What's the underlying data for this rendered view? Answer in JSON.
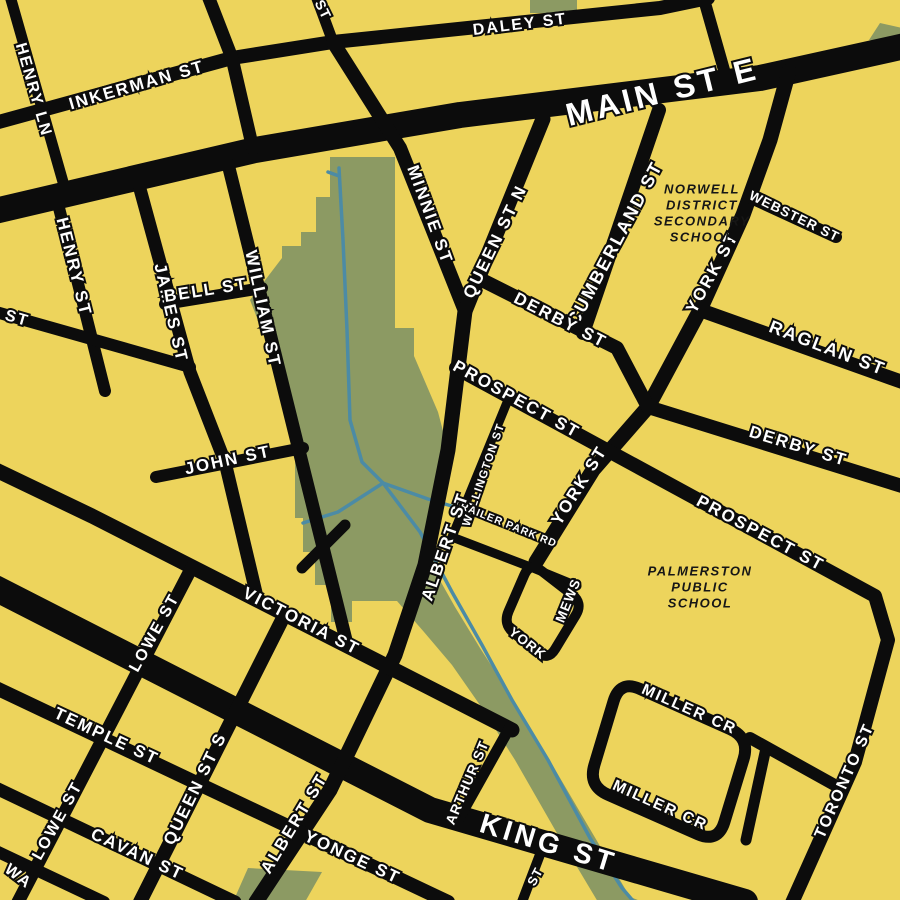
{
  "map": {
    "title_visible": false,
    "place_names_visible": [
      "Palmerston street map"
    ],
    "colors": {
      "background": "#EDD45C",
      "road": "#0C0C0C",
      "park": "#8C9A63",
      "creek": "#4C8BA5",
      "street_label_text": "#FFFFFF",
      "poi_label_text": "#161616"
    },
    "canvas": {
      "width": 900,
      "height": 900
    }
  },
  "street_labels": [
    {
      "id": "inkerman-st",
      "text": "INKERMAN ST",
      "x": 137,
      "y": 86,
      "rot": -16,
      "size": 17
    },
    {
      "id": "daley-st",
      "text": "DALEY ST",
      "x": 520,
      "y": 25,
      "rot": -7,
      "size": 16
    },
    {
      "id": "main-st-e",
      "text": "MAIN ST E",
      "x": 663,
      "y": 94,
      "rot": -14,
      "size": 32
    },
    {
      "id": "henry-ln",
      "text": "HENRY LN",
      "x": 33,
      "y": 90,
      "rot": 74,
      "size": 16
    },
    {
      "id": "st-fragment-north",
      "text": "ST",
      "x": 322,
      "y": 10,
      "rot": 64,
      "size": 14
    },
    {
      "id": "henry-st",
      "text": "HENRY ST",
      "x": 73,
      "y": 267,
      "rot": 76,
      "size": 17
    },
    {
      "id": "st-fragment-west",
      "text": "ST",
      "x": 17,
      "y": 319,
      "rot": 16,
      "size": 16
    },
    {
      "id": "james-st",
      "text": "JAMES ST",
      "x": 170,
      "y": 313,
      "rot": 77,
      "size": 17
    },
    {
      "id": "bell-st",
      "text": "BELL ST",
      "x": 206,
      "y": 291,
      "rot": -9,
      "size": 17
    },
    {
      "id": "william-st",
      "text": "WILLIAM ST",
      "x": 262,
      "y": 309,
      "rot": 78,
      "size": 17
    },
    {
      "id": "john-st",
      "text": "JOHN ST",
      "x": 228,
      "y": 461,
      "rot": -12,
      "size": 17
    },
    {
      "id": "minnie-st",
      "text": "MINNIE ST",
      "x": 429,
      "y": 215,
      "rot": 70,
      "size": 17
    },
    {
      "id": "queen-st-n",
      "text": "QUEEN ST N",
      "x": 496,
      "y": 242,
      "rot": -64,
      "size": 17
    },
    {
      "id": "cumberland-st",
      "text": "CUMBERLAND ST",
      "x": 616,
      "y": 244,
      "rot": -62,
      "size": 18
    },
    {
      "id": "webster-st",
      "text": "WEBSTER ST",
      "x": 794,
      "y": 217,
      "rot": 26,
      "size": 13.5
    },
    {
      "id": "raglan-st",
      "text": "RAGLAN ST",
      "x": 827,
      "y": 349,
      "rot": 21,
      "size": 18
    },
    {
      "id": "derby-st-w",
      "text": "DERBY ST",
      "x": 560,
      "y": 321,
      "rot": 27,
      "size": 17
    },
    {
      "id": "derby-st-e",
      "text": "DERBY ST",
      "x": 798,
      "y": 447,
      "rot": 17,
      "size": 17
    },
    {
      "id": "prospect-st-w",
      "text": "PROSPECT ST",
      "x": 516,
      "y": 400,
      "rot": 29,
      "size": 17
    },
    {
      "id": "prospect-st-e",
      "text": "PROSPECT ST",
      "x": 760,
      "y": 534,
      "rot": 28,
      "size": 17
    },
    {
      "id": "wellington-st",
      "text": "WELLINGTON ST",
      "x": 484,
      "y": 475,
      "rot": -71,
      "size": 11.5
    },
    {
      "id": "trailer-park-rd",
      "text": "TRAILER PARK RD",
      "x": 505,
      "y": 524,
      "rot": 22,
      "size": 10.5
    },
    {
      "id": "york-st-n",
      "text": "YORK ST",
      "x": 713,
      "y": 273,
      "rot": -61,
      "size": 17
    },
    {
      "id": "york-st-s",
      "text": "YORK ST",
      "x": 580,
      "y": 486,
      "rot": -58,
      "size": 17
    },
    {
      "id": "york-mews-york",
      "text": "YORK",
      "x": 527,
      "y": 644,
      "rot": 38,
      "size": 13.5
    },
    {
      "id": "york-mews-mews",
      "text": "MEWS",
      "x": 569,
      "y": 601,
      "rot": -68,
      "size": 13.5
    },
    {
      "id": "victoria-st",
      "text": "VICTORIA ST",
      "x": 301,
      "y": 622,
      "rot": 27,
      "size": 17
    },
    {
      "id": "lowe-st-n",
      "text": "LOWE ST",
      "x": 155,
      "y": 633,
      "rot": -61,
      "size": 16
    },
    {
      "id": "temple-st",
      "text": "TEMPLE ST",
      "x": 106,
      "y": 737,
      "rot": 25,
      "size": 17
    },
    {
      "id": "queen-st-s",
      "text": "QUEEN ST S",
      "x": 196,
      "y": 789,
      "rot": -64,
      "size": 17
    },
    {
      "id": "lowe-st-s",
      "text": "LOWE ST",
      "x": 58,
      "y": 821,
      "rot": -61,
      "size": 16
    },
    {
      "id": "cavan-st",
      "text": "CAVAN ST",
      "x": 137,
      "y": 855,
      "rot": 25,
      "size": 17
    },
    {
      "id": "wa-fragment",
      "text": "WA",
      "x": 18,
      "y": 877,
      "rot": 38,
      "size": 16
    },
    {
      "id": "albert-st-n",
      "text": "ALBERT ST",
      "x": 446,
      "y": 547,
      "rot": -71,
      "size": 17
    },
    {
      "id": "albert-st-s",
      "text": "ALBERT ST",
      "x": 295,
      "y": 824,
      "rot": -59,
      "size": 17
    },
    {
      "id": "yonge-st",
      "text": "YONGE ST",
      "x": 352,
      "y": 858,
      "rot": 25,
      "size": 17
    },
    {
      "id": "arthur-st",
      "text": "ARTHUR ST",
      "x": 468,
      "y": 783,
      "rot": -67,
      "size": 14
    },
    {
      "id": "king-st",
      "text": "KING ST",
      "x": 548,
      "y": 845,
      "rot": 17,
      "size": 28
    },
    {
      "id": "st-fragment-south",
      "text": "ST",
      "x": 536,
      "y": 877,
      "rot": -62,
      "size": 13
    },
    {
      "id": "miller-cr-n",
      "text": "MILLER CR",
      "x": 689,
      "y": 710,
      "rot": 24,
      "size": 15.5
    },
    {
      "id": "miller-cr-s",
      "text": "MILLER CR",
      "x": 660,
      "y": 806,
      "rot": 24,
      "size": 15.5
    },
    {
      "id": "toronto-st",
      "text": "TORONTO ST",
      "x": 845,
      "y": 781,
      "rot": -66,
      "size": 16
    }
  ],
  "poi_labels": [
    {
      "id": "norwell-district-secondary-school",
      "lines": [
        "NORWELL",
        "DISTRICT",
        "SECONDARY",
        "SCHOOL"
      ],
      "x": 702,
      "y": 190,
      "line_height": 16,
      "size": 13
    },
    {
      "id": "palmerston-public-school",
      "lines": [
        "PALMERSTON",
        "PUBLIC",
        "SCHOOL"
      ],
      "x": 700,
      "y": 572,
      "line_height": 16,
      "size": 13
    }
  ],
  "roads": [
    {
      "id": "main-st",
      "width": 26,
      "pts": [
        [
          -5,
          211
        ],
        [
          255,
          150
        ],
        [
          460,
          115
        ],
        [
          760,
          78
        ],
        [
          905,
          46
        ]
      ]
    },
    {
      "id": "king-st",
      "width": 26,
      "pts": [
        [
          -5,
          588
        ],
        [
          430,
          810
        ],
        [
          745,
          902
        ]
      ]
    },
    {
      "id": "inkerman-daley-st",
      "width": 14,
      "pts": [
        [
          -5,
          123
        ],
        [
          232,
          58
        ],
        [
          333,
          42
        ],
        [
          660,
          8
        ],
        [
          708,
          -2
        ]
      ]
    },
    {
      "id": "henry-ln",
      "width": 11,
      "pts": [
        [
          10,
          -4
        ],
        [
          67,
          196
        ]
      ]
    },
    {
      "id": "north-street-1",
      "width": 13,
      "pts": [
        [
          208,
          -4
        ],
        [
          232,
          58
        ],
        [
          253,
          149
        ]
      ]
    },
    {
      "id": "north-street-2",
      "width": 11,
      "pts": [
        [
          316,
          -4
        ],
        [
          333,
          42
        ]
      ]
    },
    {
      "id": "north-street-3",
      "width": 12,
      "pts": [
        [
          703,
          -4
        ],
        [
          728,
          84
        ]
      ]
    },
    {
      "id": "henry-st",
      "width": 12,
      "pts": [
        [
          55,
          192
        ],
        [
          105,
          391
        ]
      ]
    },
    {
      "id": "west-street",
      "width": 12,
      "pts": [
        [
          -4,
          312
        ],
        [
          190,
          367
        ]
      ]
    },
    {
      "id": "james-st",
      "width": 13,
      "pts": [
        [
          140,
          189
        ],
        [
          190,
          372
        ],
        [
          225,
          462
        ],
        [
          258,
          601
        ]
      ]
    },
    {
      "id": "william-st",
      "width": 13,
      "pts": [
        [
          228,
          164
        ],
        [
          347,
          644
        ]
      ]
    },
    {
      "id": "bell-st",
      "width": 12,
      "pts": [
        [
          165,
          304
        ],
        [
          262,
          288
        ]
      ]
    },
    {
      "id": "john-st",
      "width": 12,
      "pts": [
        [
          156,
          477
        ],
        [
          303,
          448
        ]
      ]
    },
    {
      "id": "minnie-st",
      "width": 14,
      "pts": [
        [
          333,
          42
        ],
        [
          400,
          148
        ],
        [
          465,
          311
        ]
      ]
    },
    {
      "id": "queen-st-n",
      "width": 15,
      "pts": [
        [
          543,
          119
        ],
        [
          465,
          311
        ]
      ]
    },
    {
      "id": "albert-st",
      "width": 15,
      "pts": [
        [
          465,
          311
        ],
        [
          448,
          450
        ],
        [
          425,
          565
        ],
        [
          395,
          655
        ],
        [
          330,
          790
        ],
        [
          256,
          902
        ]
      ]
    },
    {
      "id": "cumberland-st",
      "width": 14,
      "pts": [
        [
          659,
          110
        ],
        [
          583,
          333
        ]
      ]
    },
    {
      "id": "york-st",
      "width": 15,
      "pts": [
        [
          789,
          71
        ],
        [
          770,
          140
        ],
        [
          743,
          215
        ],
        [
          700,
          310
        ],
        [
          648,
          407
        ],
        [
          593,
          470
        ],
        [
          536,
          562
        ]
      ]
    },
    {
      "id": "webster-st",
      "width": 12,
      "pts": [
        [
          749,
          197
        ],
        [
          836,
          237
        ]
      ]
    },
    {
      "id": "raglan-st",
      "width": 14,
      "pts": [
        [
          700,
          310
        ],
        [
          905,
          383
        ]
      ]
    },
    {
      "id": "derby-st",
      "width": 14,
      "pts": [
        [
          478,
          278
        ],
        [
          617,
          348
        ],
        [
          648,
          407
        ],
        [
          905,
          487
        ]
      ]
    },
    {
      "id": "prospect-toronto-st",
      "width": 14,
      "pts": [
        [
          456,
          368
        ],
        [
          875,
          596
        ],
        [
          888,
          640
        ],
        [
          855,
          762
        ],
        [
          791,
          905
        ]
      ]
    },
    {
      "id": "wellington-st",
      "width": 9,
      "pts": [
        [
          508,
          400
        ],
        [
          452,
          537
        ]
      ]
    },
    {
      "id": "trailer-park-rd",
      "width": 9,
      "pts": [
        [
          452,
          537
        ],
        [
          533,
          568
        ],
        [
          577,
          586
        ]
      ]
    },
    {
      "id": "york-mews",
      "width": 10,
      "closed": true,
      "r": 14,
      "pts": [
        [
          530,
          562
        ],
        [
          583,
          603
        ],
        [
          548,
          661
        ],
        [
          503,
          624
        ]
      ]
    },
    {
      "id": "victoria-st",
      "width": 15,
      "pts": [
        [
          -4,
          470
        ],
        [
          92,
          516
        ],
        [
          430,
          688
        ],
        [
          512,
          730
        ]
      ]
    },
    {
      "id": "victoria-park-stub",
      "width": 11,
      "pts": [
        [
          302,
          568
        ],
        [
          345,
          525
        ]
      ]
    },
    {
      "id": "lowe-st",
      "width": 13,
      "pts": [
        [
          192,
          567
        ],
        [
          18,
          902
        ]
      ]
    },
    {
      "id": "queen-st-s",
      "width": 14,
      "pts": [
        [
          285,
          614
        ],
        [
          140,
          902
        ]
      ]
    },
    {
      "id": "temple-yonge-st",
      "width": 14,
      "pts": [
        [
          -4,
          688
        ],
        [
          448,
          902
        ]
      ]
    },
    {
      "id": "cavan-st",
      "width": 13,
      "pts": [
        [
          -4,
          788
        ],
        [
          235,
          902
        ]
      ]
    },
    {
      "id": "wa-street",
      "width": 12,
      "pts": [
        [
          -4,
          851
        ],
        [
          104,
          902
        ]
      ]
    },
    {
      "id": "arthur-st",
      "width": 11,
      "pts": [
        [
          510,
          727
        ],
        [
          458,
          820
        ]
      ]
    },
    {
      "id": "king-stub",
      "width": 10,
      "pts": [
        [
          544,
          844
        ],
        [
          522,
          902
        ]
      ]
    },
    {
      "id": "miller-cr",
      "width": 12,
      "closed": true,
      "r": 22,
      "pts": [
        [
          620,
          680
        ],
        [
          750,
          738
        ],
        [
          718,
          843
        ],
        [
          588,
          786
        ]
      ]
    },
    {
      "id": "miller-connector",
      "width": 12,
      "pts": [
        [
          750,
          738
        ],
        [
          840,
          788
        ]
      ]
    },
    {
      "id": "miller-stub",
      "width": 11,
      "pts": [
        [
          766,
          748
        ],
        [
          746,
          840
        ]
      ]
    }
  ],
  "parks": [
    {
      "id": "mill-creek-park",
      "pts": [
        [
          330,
          157
        ],
        [
          395,
          157
        ],
        [
          395,
          328
        ],
        [
          414,
          328
        ],
        [
          414,
          356
        ],
        [
          438,
          412
        ],
        [
          448,
          450
        ],
        [
          433,
          520
        ],
        [
          433,
          568
        ],
        [
          455,
          607
        ],
        [
          480,
          648
        ],
        [
          507,
          690
        ],
        [
          546,
          754
        ],
        [
          587,
          824
        ],
        [
          630,
          897
        ],
        [
          643,
          902
        ],
        [
          598,
          902
        ],
        [
          558,
          835
        ],
        [
          515,
          760
        ],
        [
          482,
          708
        ],
        [
          452,
          665
        ],
        [
          424,
          632
        ],
        [
          397,
          601
        ],
        [
          352,
          601
        ],
        [
          352,
          622
        ],
        [
          331,
          622
        ],
        [
          331,
          585
        ],
        [
          315,
          585
        ],
        [
          315,
          552
        ],
        [
          303,
          552
        ],
        [
          303,
          518
        ],
        [
          295,
          518
        ],
        [
          295,
          415
        ],
        [
          250,
          300
        ],
        [
          282,
          258
        ],
        [
          282,
          246
        ],
        [
          301,
          246
        ],
        [
          301,
          232
        ],
        [
          316,
          232
        ],
        [
          316,
          197
        ],
        [
          330,
          197
        ]
      ]
    },
    {
      "id": "green-patch-north-1",
      "pts": [
        [
          530,
          -2
        ],
        [
          577,
          -2
        ],
        [
          577,
          13
        ],
        [
          530,
          13
        ]
      ]
    },
    {
      "id": "green-patch-north-2",
      "pts": [
        [
          869,
          40
        ],
        [
          880,
          23
        ],
        [
          902,
          28
        ],
        [
          902,
          47
        ]
      ]
    },
    {
      "id": "green-patch-south",
      "pts": [
        [
          248,
          868
        ],
        [
          322,
          872
        ],
        [
          305,
          902
        ],
        [
          233,
          902
        ]
      ]
    }
  ],
  "creeks": [
    {
      "id": "creek-main",
      "pts": [
        [
          339,
          168
        ],
        [
          343,
          240
        ],
        [
          347,
          330
        ],
        [
          350,
          420
        ],
        [
          362,
          462
        ],
        [
          383,
          483
        ]
      ]
    },
    {
      "id": "creek-west",
      "pts": [
        [
          383,
          483
        ],
        [
          338,
          512
        ],
        [
          303,
          523
        ]
      ]
    },
    {
      "id": "creek-southeast",
      "pts": [
        [
          383,
          483
        ],
        [
          420,
          532
        ],
        [
          452,
          592
        ],
        [
          482,
          645
        ],
        [
          512,
          700
        ],
        [
          548,
          760
        ],
        [
          590,
          838
        ],
        [
          622,
          888
        ],
        [
          634,
          902
        ]
      ]
    },
    {
      "id": "creek-northeast",
      "pts": [
        [
          383,
          483
        ],
        [
          428,
          499
        ],
        [
          455,
          507
        ]
      ]
    },
    {
      "id": "creek-top-twig",
      "pts": [
        [
          339,
          176
        ],
        [
          328,
          172
        ]
      ]
    }
  ]
}
